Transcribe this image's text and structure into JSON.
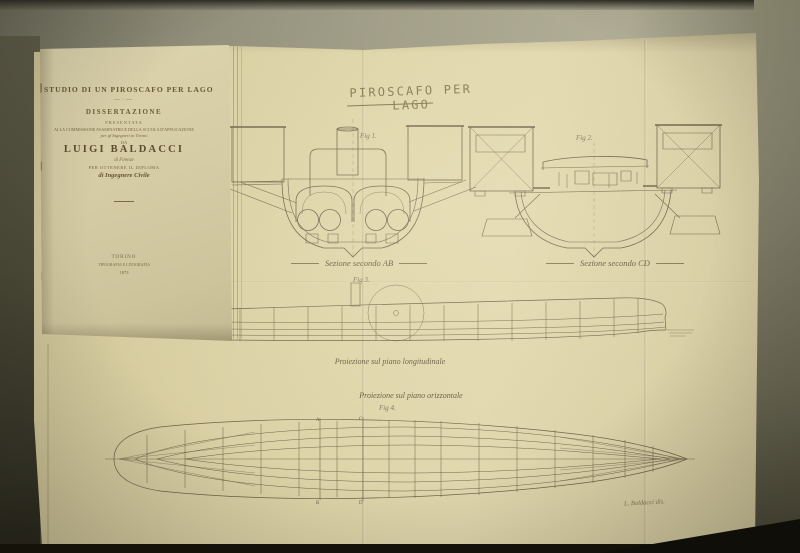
{
  "booklet": {
    "title": "STUDIO DI UN PIROSCAFO PER LAGO",
    "flourish": "—·—",
    "dissertation": "DISSERTAZIONE",
    "presented": "PRESENTATA",
    "commission_line": "ALLA COMMISSIONE ESAMINATRICE DELLA SCUOLA D'APPLICAZIONE",
    "engineers_line": "per gl'Ingegneri in Torino",
    "da": "DA",
    "author": "LUIGI BALDACCI",
    "origin": "di Firenze",
    "diploma_line": "PER OTTENERE IL DIPLOMA",
    "degree_line": "di Ingegnere Civile",
    "imprint_city": "TORINO",
    "imprint_printer": "TIPOGRAFIA E LITOGRAFIA",
    "imprint_year": "1873"
  },
  "plate": {
    "title": "PIROSCAFO PER LAGO",
    "fig1": {
      "label": "Fig 1.",
      "caption": "Sezione secondo AB"
    },
    "fig2": {
      "label": "Fig 2.",
      "caption": "Sezione secondo CD"
    },
    "fig3": {
      "label": "Fig 3.",
      "caption": "Proiezione sul piano longitudinale"
    },
    "fig4": {
      "label": "Fig 4.",
      "caption": "Proiezione sul piano orizzontale"
    },
    "plan_marks": {
      "top_left": "A",
      "top_right": "C",
      "bottom_left": "B",
      "bottom_right": "D"
    },
    "signature": "L. Baldacci dis."
  },
  "colors": {
    "plate_paper": "#ded4a9",
    "booklet_paper": "#d6cda6",
    "drawing_ink": "#6b6149",
    "backdrop": "#9a9883",
    "shadow_dark": "#131109"
  }
}
